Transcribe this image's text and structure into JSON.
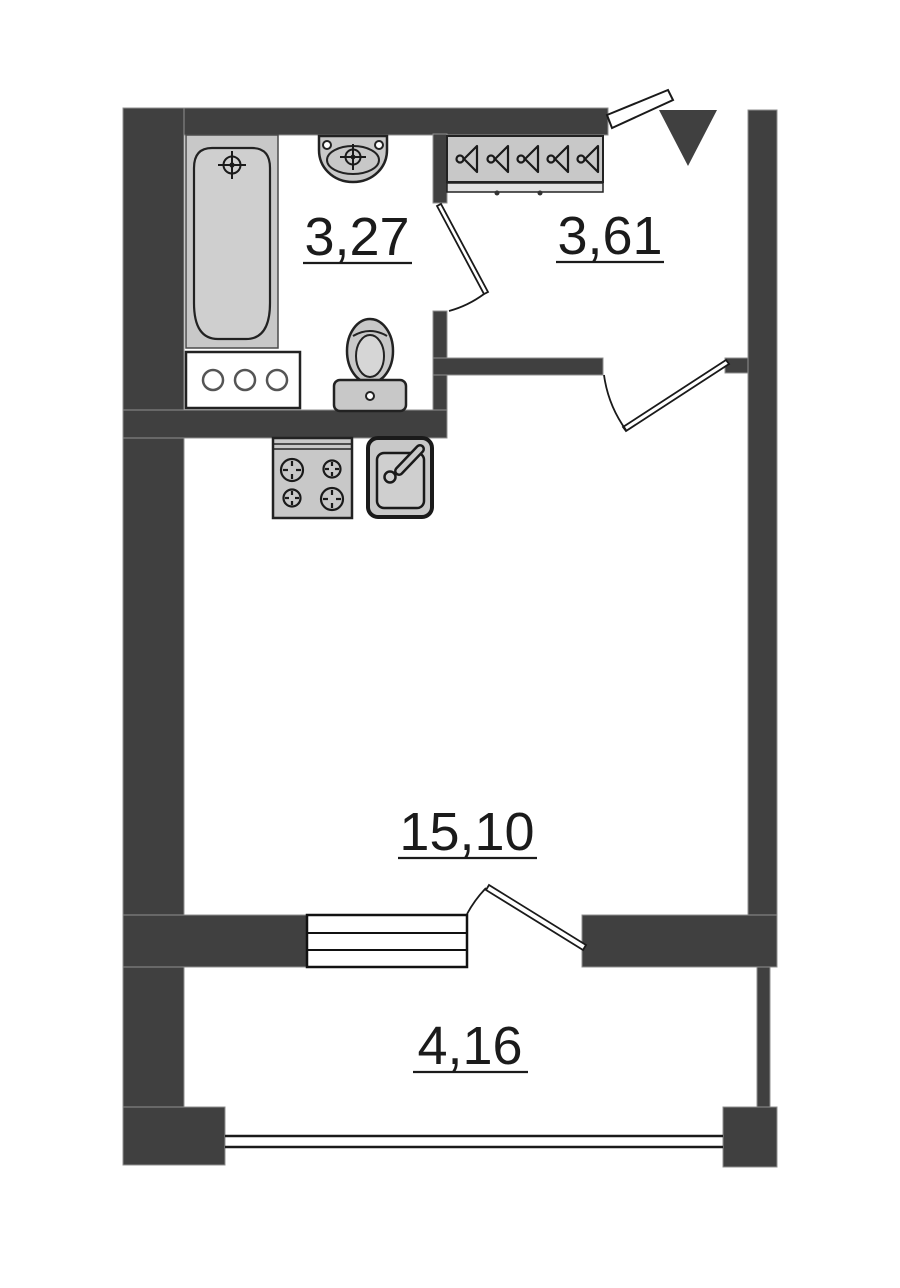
{
  "plan": {
    "type": "apartment-floor-plan",
    "background": "#ffffff",
    "wall_color": "#404040",
    "fixture_fill": "#c8c8c8",
    "line_color": "#1a1a1a",
    "rooms": [
      {
        "id": "bathroom",
        "area": "3,27"
      },
      {
        "id": "hallway",
        "area": "3,61"
      },
      {
        "id": "living-room",
        "area": "15,10"
      },
      {
        "id": "balcony",
        "area": "4,16"
      }
    ],
    "fixtures": [
      "bathtub",
      "wash-basin",
      "washing-cabinet",
      "toilet",
      "wardrobe-with-hangers",
      "stove",
      "kitchen-sink",
      "window",
      "balcony-railing",
      "entrance-arrow"
    ]
  }
}
